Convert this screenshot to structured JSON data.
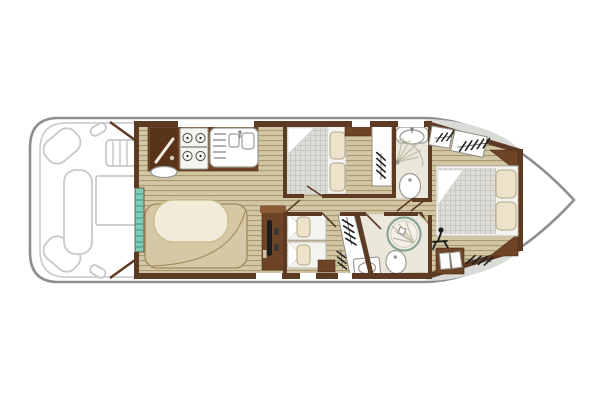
{
  "page": {
    "kind": "boat-floor-plan-diagram",
    "orientation": "bow-right"
  },
  "colors": {
    "white": "#ffffff",
    "hull_outline": "#8a8f93",
    "deck_outline": "#c6c9cb",
    "gunwale": "#dadad6",
    "wall": "#5c3a24",
    "furniture_brown": "#6e4426",
    "furniture_brown_light": "#8a5a36",
    "wood_light": "#d2c6a4",
    "wood_dark": "#a3946c",
    "bench": "#d6c8a4",
    "bench_outline": "#a0895a",
    "table": "#f1ebd8",
    "teal": "#7fcdb8",
    "teal_line": "#3f9a82",
    "mattress": "#dddcd6",
    "mattress_grid": "#c4c3bc",
    "pillow": "#ece3ca",
    "pillow_outline": "#b5a684",
    "bath_floor": "#ebe7db",
    "fixture_outline": "#9a9a94",
    "shower_ring": "#8aa392",
    "icon_black": "#1c1c1c"
  },
  "areas": [
    {
      "id": "aft-deck",
      "items": [
        "corner-seat",
        "corner-seat",
        "side-bench",
        "deck-table",
        "boarding-steps",
        "cleat",
        "cleat"
      ]
    },
    {
      "id": "saloon-galley",
      "items": [
        "entry-steps",
        "galley-cabinet",
        "stove",
        "double-sink",
        "dinette-bench",
        "dinette-table",
        "helm-console",
        "steering-wheel"
      ]
    },
    {
      "id": "port-cabin",
      "items": [
        "double-bed",
        "pillow",
        "pillow",
        "shelf",
        "wardrobe-hangers"
      ]
    },
    {
      "id": "port-bathroom",
      "items": [
        "washbasin",
        "corner-shower",
        "toilet"
      ]
    },
    {
      "id": "starboard-cabin",
      "items": [
        "single-bed",
        "single-bed",
        "foot-cabinet",
        "wardrobe-hangers"
      ]
    },
    {
      "id": "starboard-bathroom",
      "items": [
        "round-shower",
        "toilet",
        "washbasin"
      ]
    },
    {
      "id": "bow-cabin",
      "items": [
        "double-bed",
        "pillow",
        "pillow",
        "hanger-locker",
        "hanger-locker",
        "vanity-stool",
        "door-cabinet",
        "hanger-locker"
      ]
    },
    {
      "id": "bow-deck",
      "items": []
    }
  ]
}
